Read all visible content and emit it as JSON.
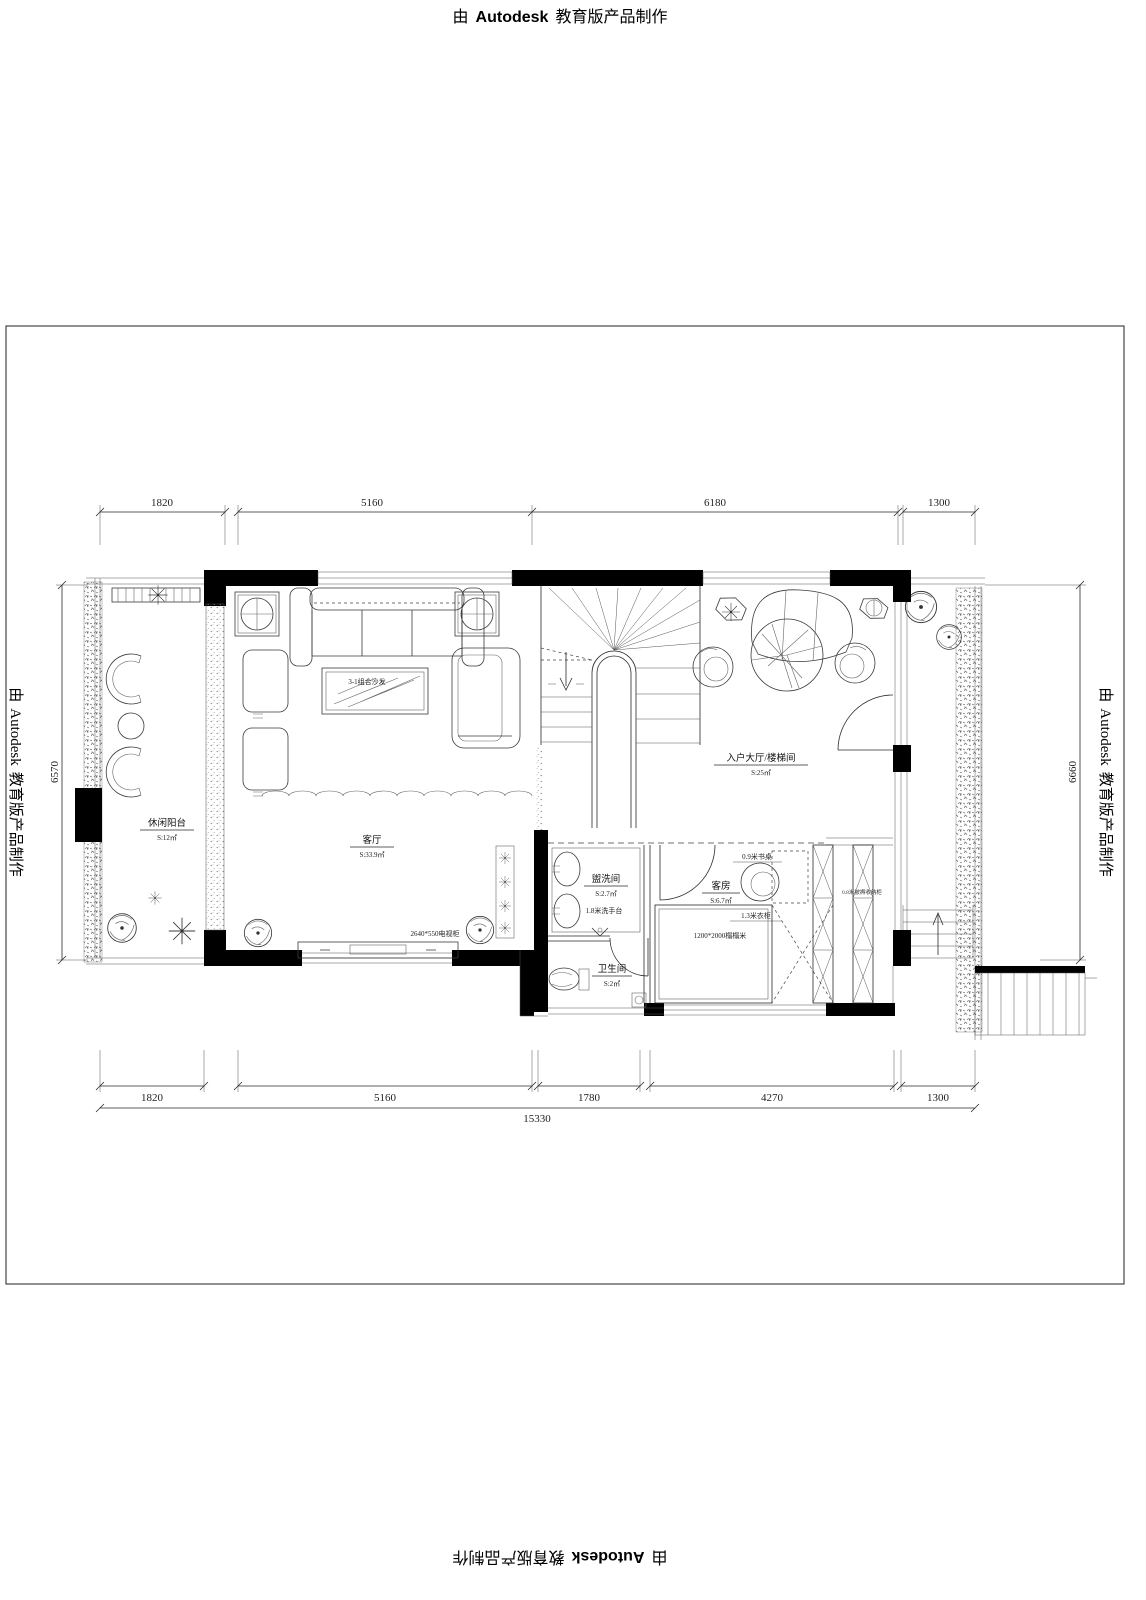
{
  "stamp": {
    "pre": "由",
    "brand": "Autodesk",
    "post": "教育版产品制作"
  },
  "dimensions": {
    "top": [
      "1820",
      "5160",
      "6180",
      "1300"
    ],
    "bottom": [
      "1820",
      "5160",
      "1780",
      "4270",
      "1300"
    ],
    "total": "15330",
    "left": "6570",
    "right": "6660"
  },
  "rooms": {
    "balcony": {
      "name": "休闲阳台",
      "area": "S:12㎡"
    },
    "living": {
      "name": "客厅",
      "area": "S:33.9㎡"
    },
    "hall": {
      "name": "入户大厅/楼梯间",
      "area": "S:25㎡"
    },
    "washroom": {
      "name": "盥洗间",
      "area": "S:2.7㎡",
      "note": "1.8米洗手台"
    },
    "bathroom": {
      "name": "卫生间",
      "area": "S:2㎡"
    },
    "guest": {
      "name": "客房",
      "area": "S:6.7㎡"
    }
  },
  "furniture": {
    "sofa": "3-1组合沙发",
    "tv": "2640*550电视柜",
    "desk": "0.9米书桌",
    "wardrobe": "1.3米衣柜",
    "tatami": "1200*2000榻榻米",
    "storage": "0.8米被褥收纳柜"
  }
}
